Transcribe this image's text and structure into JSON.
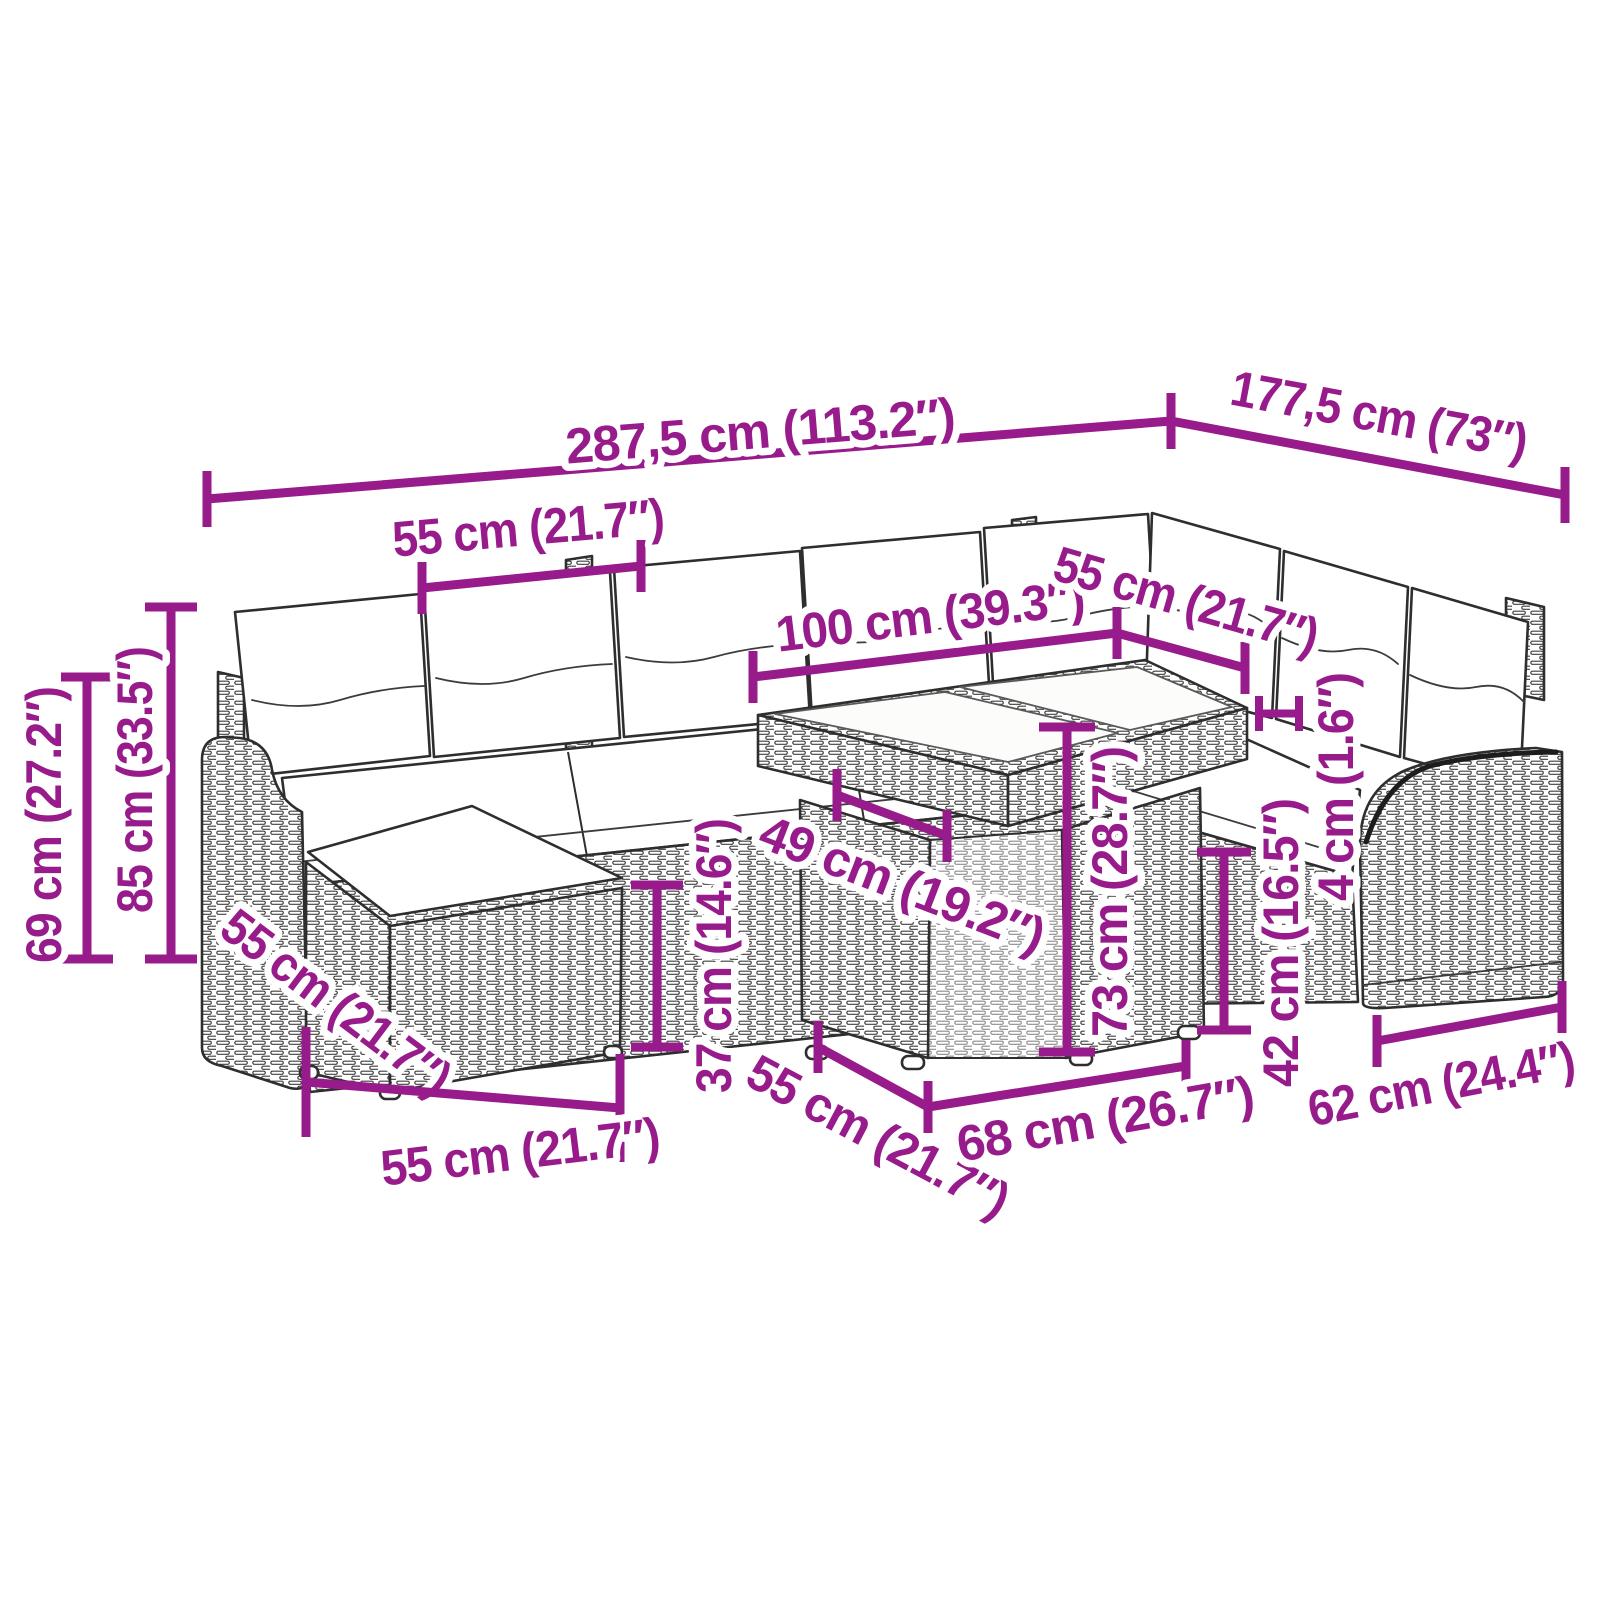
{
  "diagram": {
    "type": "product-dimensions",
    "subject": "Rattan garden lounge set with cushions, ottoman and glass-top table",
    "colors": {
      "dimension": "#981b8b",
      "halo": "#ffffff",
      "line_art": "#2e2e2e",
      "background": "#ffffff"
    },
    "dimensions": {
      "overall_width": "287,5 cm (113.2″)",
      "overall_depth": "177,5 cm (73″)",
      "back_seat_width": "55 cm (21.7″)",
      "table_length": "100 cm (39.3″)",
      "corner_seat_width": "55 cm (21.7″)",
      "armrest_height": "69 cm (27.2″)",
      "total_height": "85 cm (33.5″)",
      "ottoman_width": "55 cm (21.7″)",
      "ottoman_depth": "55 cm (21.7″)",
      "seat_height": "37 cm (14.6″)",
      "table_width": "49 cm (19.2″)",
      "table_height": "73 cm (28.7″)",
      "seat_depth": "55 cm (21.7″)",
      "table_base_width": "68 cm (26.7″)",
      "side_section_height": "42 cm (16.5″)",
      "cushion_thickness": "4 cm (1.6″)",
      "module_width": "62 cm (24.4″)"
    }
  }
}
